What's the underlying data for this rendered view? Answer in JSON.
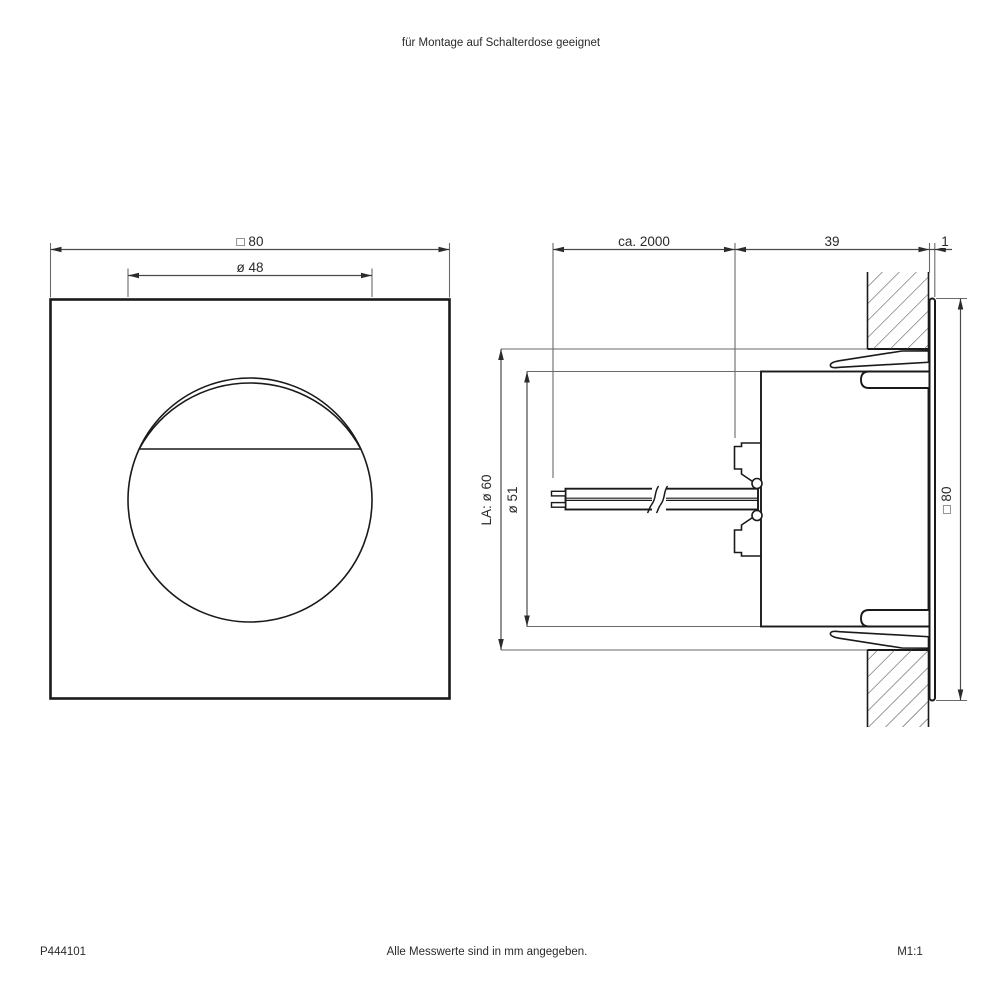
{
  "colors": {
    "background": "#ffffff",
    "object_line": "#1a1a1a",
    "dimension_line": "#4a4a4a",
    "text": "#2a2a2a"
  },
  "header": {
    "note": "für Montage auf Schalterdose geeignet"
  },
  "front": {
    "dim_width": "□ 80",
    "dim_lens": "ø 48"
  },
  "side": {
    "dim_cable": "ca. 2000",
    "dim_depth": "39",
    "dim_panel": "1",
    "dim_hole": "LA: ø 60",
    "dim_body": "ø 51",
    "dim_height": "□ 80"
  },
  "footer": {
    "article": "P444101",
    "note": "Alle Messwerte sind in mm angegeben.",
    "scale": "M1:1"
  }
}
